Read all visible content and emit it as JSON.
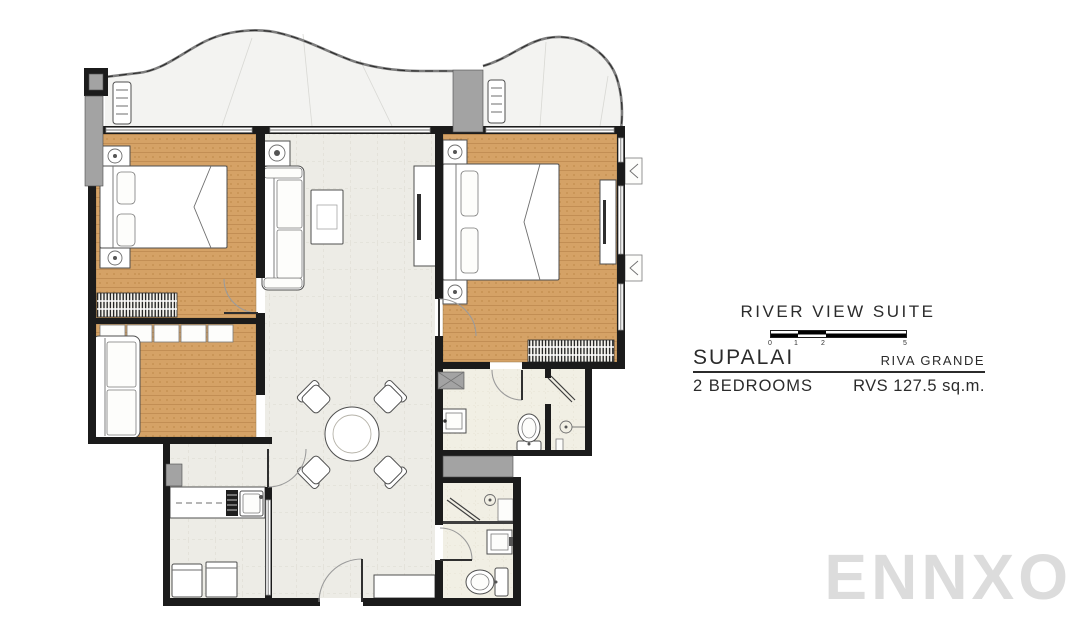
{
  "info_panel": {
    "suite_name": "RIVER VIEW SUITE",
    "scale_bar": {
      "labels": [
        "0",
        "1",
        "2",
        "5"
      ]
    },
    "developer": "SUPALAI",
    "project": "RIVA GRANDE",
    "bedrooms": "2 BEDROOMS",
    "area": "RVS 127.5 sq.m."
  },
  "watermark": "ENNXO",
  "colors": {
    "wall": "#1b1b1b",
    "wood_floor": "#d5a266",
    "wood_stripe": "#bf8c51",
    "tile_floor": "#edece6",
    "tile_line": "#d7d4c9",
    "bath_floor": "#f1efe4",
    "balcony_floor": "#f3f3f1",
    "column_gray": "#a3a3a3",
    "watermark": "#dcdcdc",
    "text": "#2b2b2b"
  }
}
